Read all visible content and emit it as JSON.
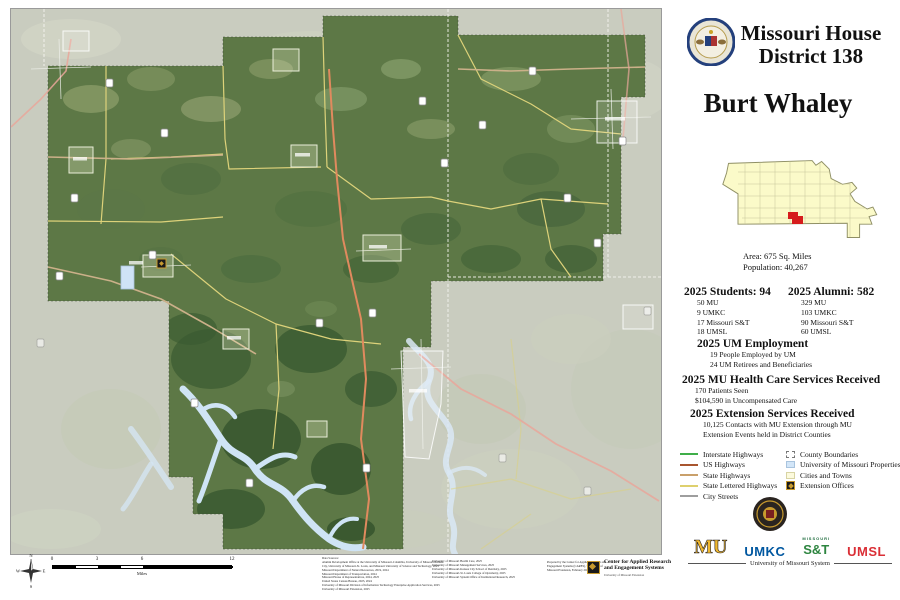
{
  "header": {
    "title_line1": "Missouri House",
    "title_line2": "District 138",
    "representative": "Burt Whaley"
  },
  "locator": {
    "area_label": "Area: 675 Sq. Miles",
    "population_label": "Population: 40,267",
    "district_color": "#d61c1c",
    "state_fill": "#fbfac9"
  },
  "stats": {
    "students": {
      "heading": "2025 Students: 94",
      "items": [
        "50 MU",
        "9 UMKC",
        "17 Missouri S&T",
        "18 UMSL"
      ]
    },
    "alumni": {
      "heading": "2025 Alumni: 582",
      "items": [
        "329 MU",
        "103 UMKC",
        "90 Missouri S&T",
        "60 UMSL"
      ]
    },
    "employment": {
      "heading": "2025 UM Employment",
      "items": [
        "19 People Employed by UM",
        "24 UM Retirees and Beneficiaries"
      ]
    },
    "health": {
      "heading": "2025 MU Health Care Services Received",
      "items": [
        "170 Patients Seen",
        "$104,590 in Uncompensated Care"
      ]
    },
    "extension": {
      "heading": "2025 Extension Services Received",
      "items": [
        "10,125 Contacts with MU Extension through MU",
        "Extension Events held in District Counties"
      ]
    }
  },
  "legend": {
    "lines": [
      {
        "label": "Interstate Highways",
        "color": "#3fae49"
      },
      {
        "label": "US Highways",
        "color": "#a8552f"
      },
      {
        "label": "State Highways",
        "color": "#c9a06b"
      },
      {
        "label": "State Lettered Highways",
        "color": "#ded06e"
      },
      {
        "label": "City Streets",
        "color": "#9e9e9e"
      }
    ],
    "areas": [
      {
        "label": "County Boundaries",
        "fill": "#ffffff",
        "border": "#777777"
      },
      {
        "label": "University of Missouri Properties",
        "fill": "#d3e6f8",
        "border": "#a9c4de"
      },
      {
        "label": "Cities and Towns",
        "fill": "#fcfadd",
        "border": "#d8d4a4"
      },
      {
        "label": "Extension Offices",
        "fill": "#c79a2e",
        "border": "#1a1a1a"
      }
    ]
  },
  "scale_bar": {
    "labels": [
      "0",
      "3",
      "6",
      "12"
    ],
    "unit": "Miles"
  },
  "logos": {
    "mu": "MU",
    "umkc": "UMKC",
    "sandt_top": "MISSOURI",
    "sandt": "S&T",
    "umsl": "UMSL",
    "system_label": "University of Missouri System"
  },
  "cares": {
    "name_line1": "Center for Applied Research",
    "name_line2": "and Engagement Systems",
    "sub": "University of Missouri Extension"
  },
  "credits": {
    "col1": [
      "Data Sources:",
      "Alumni Development Office at the University of Missouri-Columbia, University of Missouri-Kansas",
      "City, University of Missouri-St. Louis, and Missouri University of Science and Technology, 2025",
      "Missouri Department of Natural Resources, 2019, 2024",
      "Missouri Department of Transportation, 2024",
      "Missouri House of Representatives, 2024, 2025",
      "United States Census Bureau, 2023, 2024",
      "University of Missouri Division of Information Technology Enterprise Application Services, 2025",
      "University of Missouri Extension, 2025"
    ],
    "col2": [
      "University of Missouri Health Care, 2025",
      "University of Missouri Management Services, 2025",
      "University of Missouri-Kansas City School of Dentistry, 2025",
      "University of Missouri-St. Louis College of Optometry, 2025",
      "University of Missouri System Office of Institutional Research, 2025"
    ],
    "prepared_by": [
      "Prepared by the Center for Applied Research and",
      "Engagement Systems (CARES), University of",
      "Missouri Extension, February 2025"
    ]
  }
}
